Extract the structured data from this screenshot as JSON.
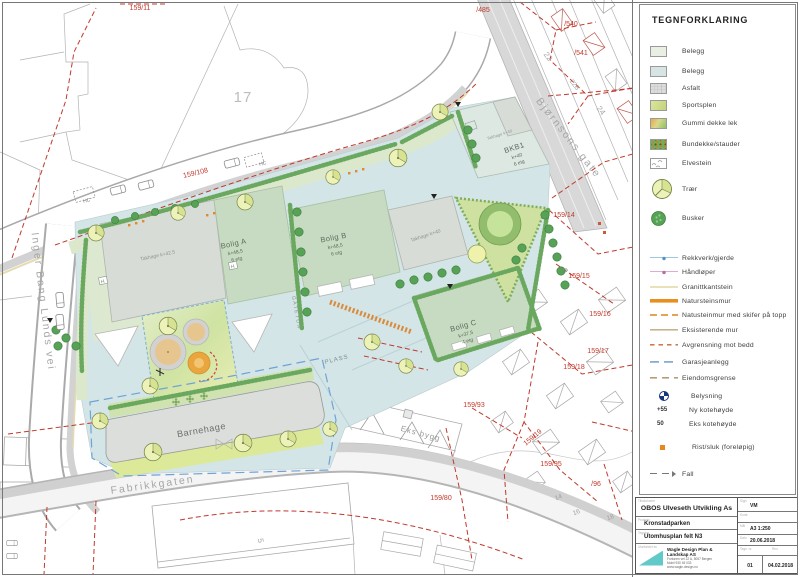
{
  "legend": {
    "title": "TEGNFORKLARING",
    "area_items": [
      {
        "label": "Belegg",
        "type": "belegg1"
      },
      {
        "label": "Belegg",
        "type": "belegg2"
      },
      {
        "label": "Asfalt",
        "type": "asfalt"
      },
      {
        "label": "Sportsplen",
        "type": "sportsplen"
      },
      {
        "label": "Gummi dekke lek",
        "type": "gummi"
      },
      {
        "label": "Bundekke/stauder",
        "type": "bundekke"
      },
      {
        "label": "Elvestein",
        "type": "elvestein"
      },
      {
        "label": "Trær",
        "type": "tre"
      },
      {
        "label": "Busker",
        "type": "busk"
      }
    ],
    "line_items": [
      {
        "label": "Rekkverk/gjerde",
        "type": "rekkverk"
      },
      {
        "label": "Håndløper",
        "type": "handloper"
      },
      {
        "label": "Granittkantstein",
        "type": "granitt"
      },
      {
        "label": "Natursteinsmur",
        "type": "natursteinsmur"
      },
      {
        "label": "Natusteinmur med skifer på topp",
        "type": "skifer"
      },
      {
        "label": "Eksisterende mur",
        "type": "eksmur"
      },
      {
        "label": "Avgrensning mot bedd",
        "type": "avgrensning"
      },
      {
        "label": "Garasjeanlegg",
        "type": "garasjeanlegg"
      },
      {
        "label": "Eiendomsgrense",
        "type": "eiendomsgrense"
      }
    ],
    "symbol_items": [
      {
        "symbol": "",
        "label": "Belysning",
        "type": "belysning"
      },
      {
        "symbol": "+55",
        "label": "Ny kotehøyde",
        "type": "ny-kote"
      },
      {
        "symbol": "50",
        "label": "Eks kotehøyde",
        "type": "eks-kote"
      },
      {
        "symbol": "",
        "label": "Rist/sluk (foreløpig)",
        "type": "rist-sluk"
      },
      {
        "symbol": "",
        "label": "Fall",
        "type": "fall"
      }
    ]
  },
  "title_block": {
    "client": "OBOS Ulveseth Utvikling As",
    "project": "Kronstadparken",
    "drawing": "Utomhusplan felt N3",
    "firm_name": "Wagle Design Plan & Landskap AS",
    "firm_addr": "Fortunen vei 22 A, 5057 Bergen",
    "firm_phone": "Mobil 930 45 033",
    "firm_web": "www.wagle-design.no",
    "sign": "VM",
    "scale": "A3 1:250",
    "date": "20.06.2018",
    "dwg_no": "01",
    "rev_date": "04.02.2018",
    "labels": {
      "client": "Tiltakshaver",
      "project": "Prosjekt",
      "drawing": "Tegning",
      "firm": "Utarbeidet av",
      "sign": "Sign.",
      "check": "Kontr.",
      "scale": "Mål",
      "date": "Dato",
      "dwg_no": "Tegn. nr.",
      "rev": "Rev."
    }
  },
  "map": {
    "streets": {
      "bjornsons_gate": "Bjørnsons gate",
      "inger_bang_lunds_vei": "Inger Bang Lunds vei",
      "fabrikkgaten": "Fabrikkgaten"
    },
    "parcels": [
      "159/11",
      "/485",
      "/540",
      "/541",
      "159/108",
      "159/14",
      "159/15",
      "159/16",
      "159/17",
      "159/18",
      "159/93",
      "159/19",
      "159/95",
      "159/80",
      "/96"
    ],
    "house_numbers": {
      "n17": "17",
      "n22": "22",
      "n22b": "22B",
      "n24": "24",
      "n5": "5",
      "n14": "14",
      "n16": "16",
      "n18": "18",
      "n2b": "2B"
    },
    "buildings": {
      "bolig_a": {
        "name": "Bolig A",
        "kote": "k+48,5",
        "etg": "6 etg"
      },
      "bolig_b": {
        "name": "Bolig B",
        "kote": "k+48,5",
        "etg": "6 etg"
      },
      "bolig_c": {
        "name": "Bolig C",
        "kote": "k+37,5",
        "etg": "4 etg"
      },
      "bkb1": {
        "name": "BKB1",
        "kote": "k+40",
        "etg": "6 etg"
      },
      "barnehage": "Barnehage",
      "eks_bygg": "Eks bygg",
      "takhage_a": "Takhage k+42,5",
      "takhage_b": "Takhage k+40",
      "takhage_bkb1": "Takhage k+40",
      "heis": "H"
    },
    "areas": {
      "plass": "PLASS",
      "gatetun": "GATETUN",
      "hc": "HC"
    }
  },
  "colors": {
    "site_surface": "#d3e5e6",
    "roof_green": "#c7dbc2",
    "roof_gray": "#d8dcd7",
    "play_orange": "#e9a63f",
    "boundary_red": "#c0392b",
    "wall_orange": "#e98f1f",
    "logo_teal": "#62c9c9"
  }
}
